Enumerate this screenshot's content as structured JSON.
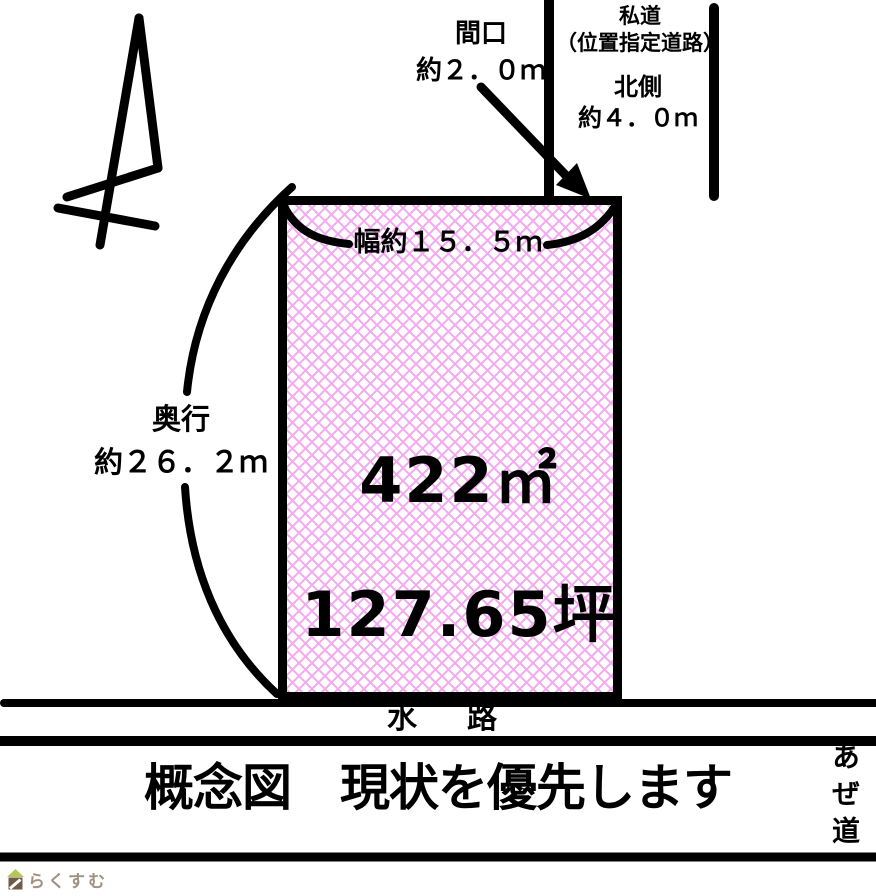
{
  "diagram": {
    "type": "land-plot-concept-sketch",
    "labels": {
      "frontage": "間口\n約２．０ｍ",
      "private_road": "私道\n（位置指定道路）",
      "north_side": "北側\n約４．０ｍ",
      "width": "幅約１５．５ｍ",
      "depth": "奥行\n約２６．２ｍ",
      "area_m2": "422㎡",
      "area_tsubo": "127.65坪",
      "waterway": "水　路",
      "footpath": "あぜ道"
    },
    "caption": "概念図　現状を優先します",
    "logo": {
      "text": "らくすむ"
    },
    "colors": {
      "line_black": "#000000",
      "hatch_pink": "#f3a9ef",
      "plot_fill": "#ffffff",
      "logo_text": "#a2917f",
      "logo_roof_green": "#b5c754",
      "logo_body_brown": "#6f5b4b"
    }
  }
}
